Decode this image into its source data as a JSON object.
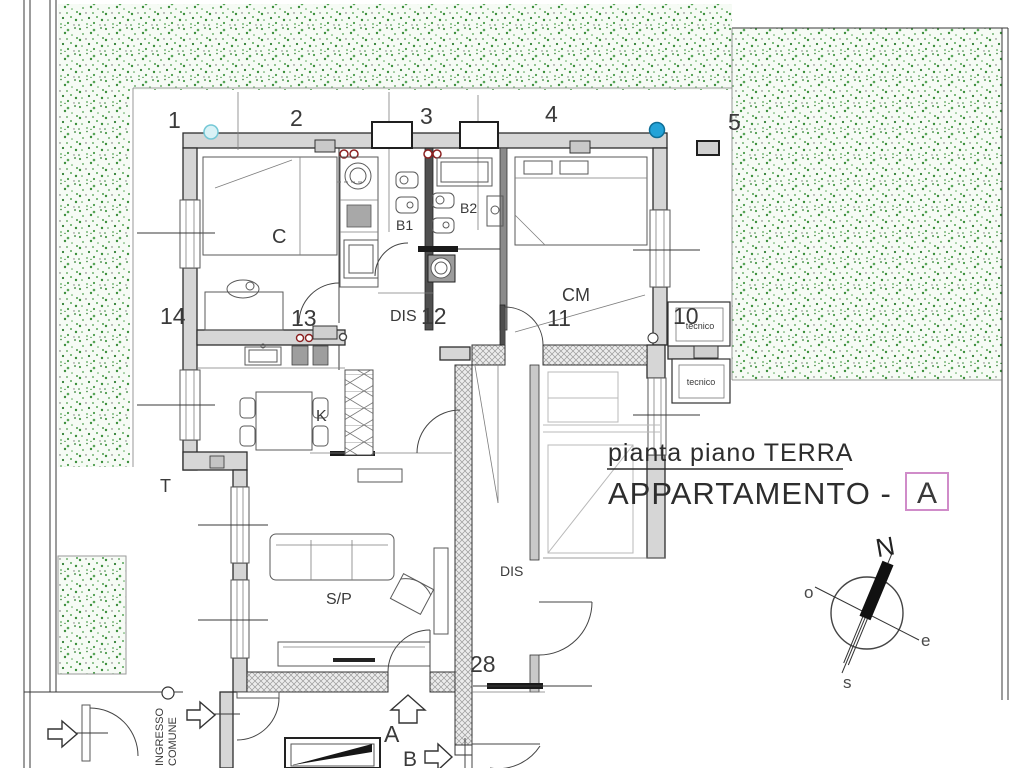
{
  "title_block": {
    "subtitle": "pianta piano TERRA",
    "main": "APPARTAMENTO -",
    "unit": "A"
  },
  "grid_numbers": {
    "n1": "1",
    "n2": "2",
    "n3": "3",
    "n4": "4",
    "n5": "5",
    "n10": "10",
    "n11": "11",
    "n12": "12",
    "n13": "13",
    "n14": "14",
    "n28": "28"
  },
  "rooms": {
    "c": "C",
    "b1": "B1",
    "b2": "B2",
    "cm": "CM",
    "dis_upper": "DIS",
    "dis_lower": "DIS",
    "k": "K",
    "sp": "S/P",
    "t": "T"
  },
  "utility": {
    "tecnico_1": "tecnico",
    "tecnico_2": "tecnico"
  },
  "entrances": {
    "a": "A",
    "b": "B"
  },
  "common_entrance": {
    "line1": "INGRESSO",
    "line2": "COMUNE"
  },
  "compass": {
    "north": "N",
    "east": "e",
    "south": "s",
    "west": "o"
  },
  "colors": {
    "garden_green": "#4a9b4a",
    "wall_gray": "#d6d6d6",
    "hatch_gray": "#9a9a9a",
    "accent_pink": "#d08cc9",
    "marker_cyan": "#d9f2f6",
    "marker_blue": "#24a3d8",
    "line_dark": "#3a3a3a"
  }
}
